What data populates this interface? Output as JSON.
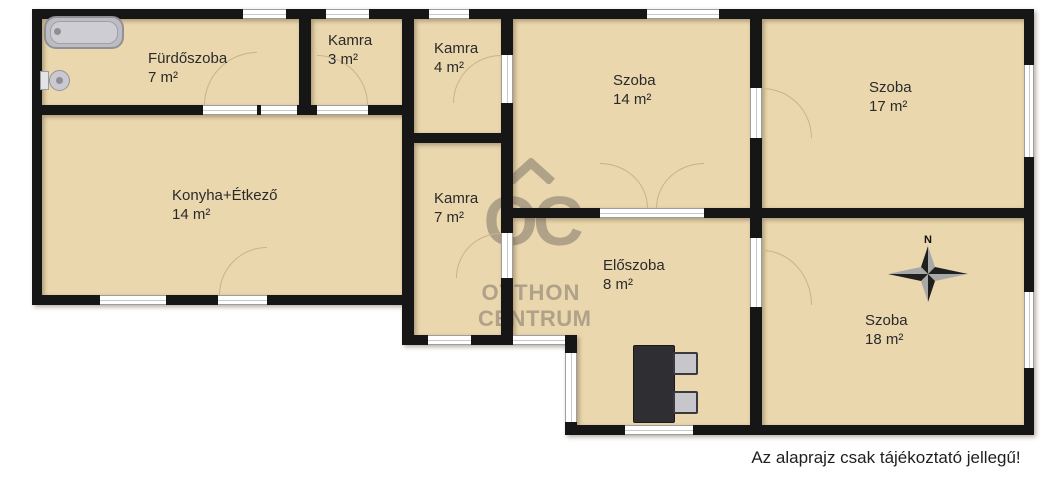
{
  "meta": {
    "disclaimer": "Az alaprajz csak tájékoztató jellegű!"
  },
  "watermark": {
    "monogram": "OC",
    "name_line1": "OTTHON",
    "name_line2": "CENTRUM"
  },
  "compass": {
    "north_label": "N"
  },
  "rooms": [
    {
      "id": "furdoszoba",
      "name": "Fürdőszoba",
      "area": "7 m²"
    },
    {
      "id": "kamra-3",
      "name": "Kamra",
      "area": "3 m²"
    },
    {
      "id": "kamra-4",
      "name": "Kamra",
      "area": "4 m²"
    },
    {
      "id": "szoba-14",
      "name": "Szoba",
      "area": "14 m²"
    },
    {
      "id": "szoba-17",
      "name": "Szoba",
      "area": "17 m²"
    },
    {
      "id": "konyha",
      "name": "Konyha+Étkező",
      "area": "14 m²"
    },
    {
      "id": "kamra-7",
      "name": "Kamra",
      "area": "7 m²"
    },
    {
      "id": "eloszoba",
      "name": "Előszoba",
      "area": "8 m²"
    },
    {
      "id": "szoba-18",
      "name": "Szoba",
      "area": "18 m²"
    }
  ],
  "colors": {
    "floor": "#ead7ae",
    "wall": "#161616",
    "watermark": "#a29480",
    "door_arc": "#c7b48a",
    "bg": "#ffffff",
    "label": "#2a2a2a"
  }
}
